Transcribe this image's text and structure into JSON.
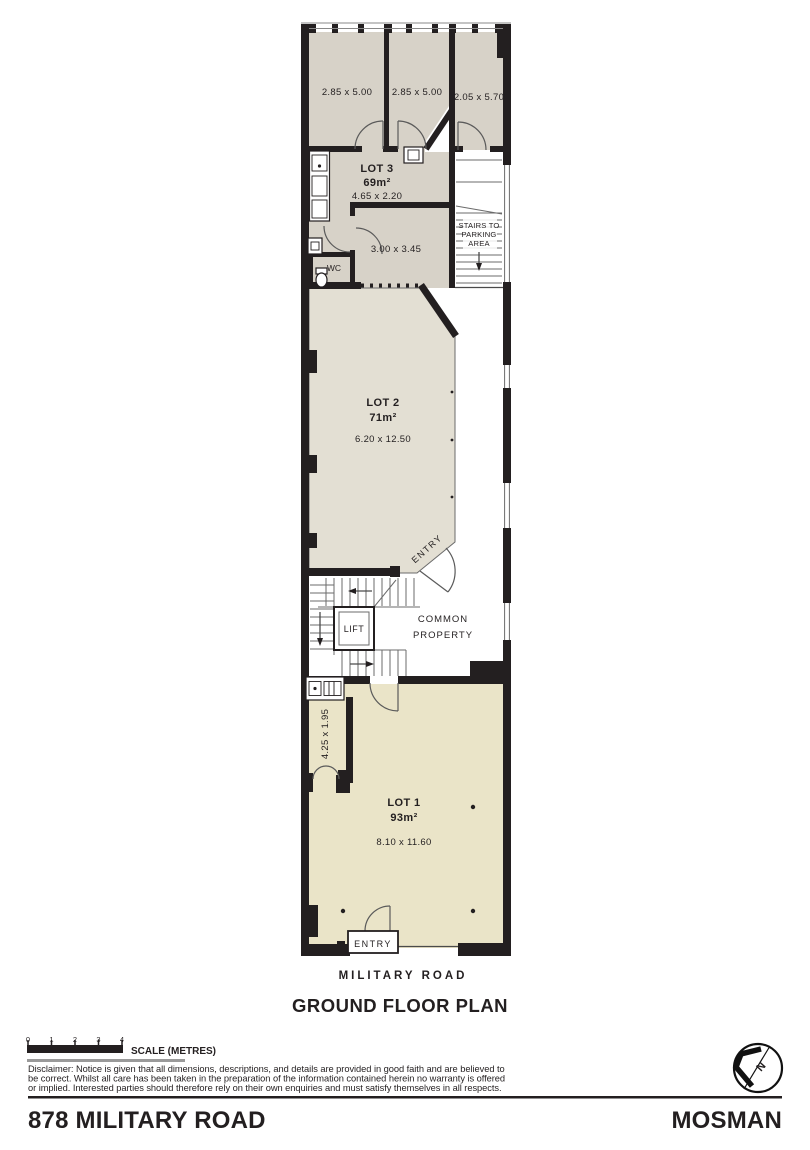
{
  "colors": {
    "room_grey": "#d7d2c8",
    "lot2_beige": "#e3dfd3",
    "lot1_cream": "#eae4c8",
    "wall": "#231f20",
    "scale_underline": "#9a9a9a"
  },
  "plan": {
    "upper_rooms": [
      {
        "dim": "2.85 x 5.00"
      },
      {
        "dim": "2.85 x 5.00"
      },
      {
        "dim": "2.05 x 5.70"
      }
    ],
    "lot3": {
      "name": "LOT 3",
      "area": "69m²",
      "dim": "4.65 x 2.20",
      "room_dim": "3.00 x 3.45",
      "wc": "WC"
    },
    "stairs": {
      "line1": "STAIRS TO",
      "line2": "PARKING",
      "line3": "AREA"
    },
    "lot2": {
      "name": "LOT 2",
      "area": "71m²",
      "dim": "6.20 x 12.50",
      "entry": "ENTRY"
    },
    "common": {
      "line1": "COMMON",
      "line2": "PROPERTY",
      "lift": "LIFT"
    },
    "lot1": {
      "name": "LOT 1",
      "area": "93m²",
      "dim": "8.10 x 11.60",
      "corridor_dim": "4.25 x 1.95",
      "entry": "ENTRY"
    },
    "street": "MILITARY ROAD",
    "title": "GROUND FLOOR PLAN"
  },
  "scale_bar": {
    "ticks": [
      "0",
      "1",
      "2",
      "3",
      "4"
    ],
    "label": "SCALE (METRES)"
  },
  "disclaimer": {
    "line1": "Disclaimer: Notice is given that all dimensions, descriptions, and details are provided in good faith and are believed to",
    "line2": "be correct. Whilst all care has been taken in the preparation of the information contained herein no warranty is offered",
    "line3": "or implied. Interested parties should therefore rely on their own enquiries and must satisfy themselves in all respects."
  },
  "footer": {
    "address": "878 MILITARY ROAD",
    "suburb": "MOSMAN"
  },
  "compass": {
    "north": "N"
  }
}
